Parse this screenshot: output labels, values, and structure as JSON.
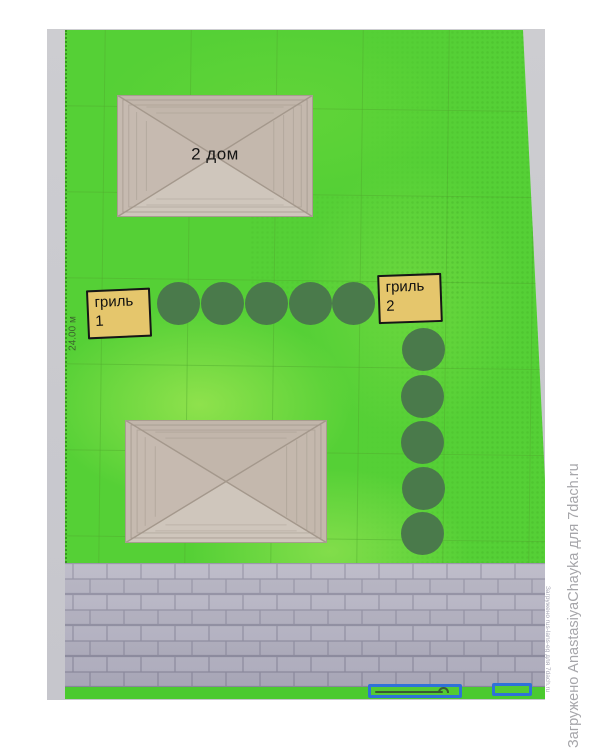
{
  "labels": {
    "house_top": "2 дом",
    "grill1_line1": "гриль",
    "grill1_line2": "1",
    "grill2_line1": "гриль",
    "grill2_line2": "2",
    "dimension_left": "24.00 м"
  },
  "watermarks": {
    "right": "Загружено AnastasiyaChayka для 7dach.ru",
    "inner": "Загружено rus-lans-eg для 7dach.ru"
  },
  "plan": {
    "trees": {
      "diameter": 43,
      "horizontal_row": [
        [
          178,
          303
        ],
        [
          222,
          303
        ],
        [
          266,
          303
        ],
        [
          310,
          303
        ],
        [
          353,
          303
        ]
      ],
      "vertical_column": [
        [
          423,
          349
        ],
        [
          422,
          396
        ],
        [
          422,
          442
        ],
        [
          423,
          488
        ],
        [
          422,
          533
        ]
      ]
    },
    "houses_count": 2,
    "blue_outlined_boxes_count": 2
  },
  "colors": {
    "lawn_green": "#55d036",
    "tree_green": "#4a7a4b",
    "label_yellow": "#e5c66c",
    "roof_beige": "#c8bdb3",
    "paver_gray": "#b4b2c1",
    "accent_blue": "#2f72d8",
    "bottom_strip_green": "#4bca2f",
    "paper_gray": "#c9c9ce"
  }
}
